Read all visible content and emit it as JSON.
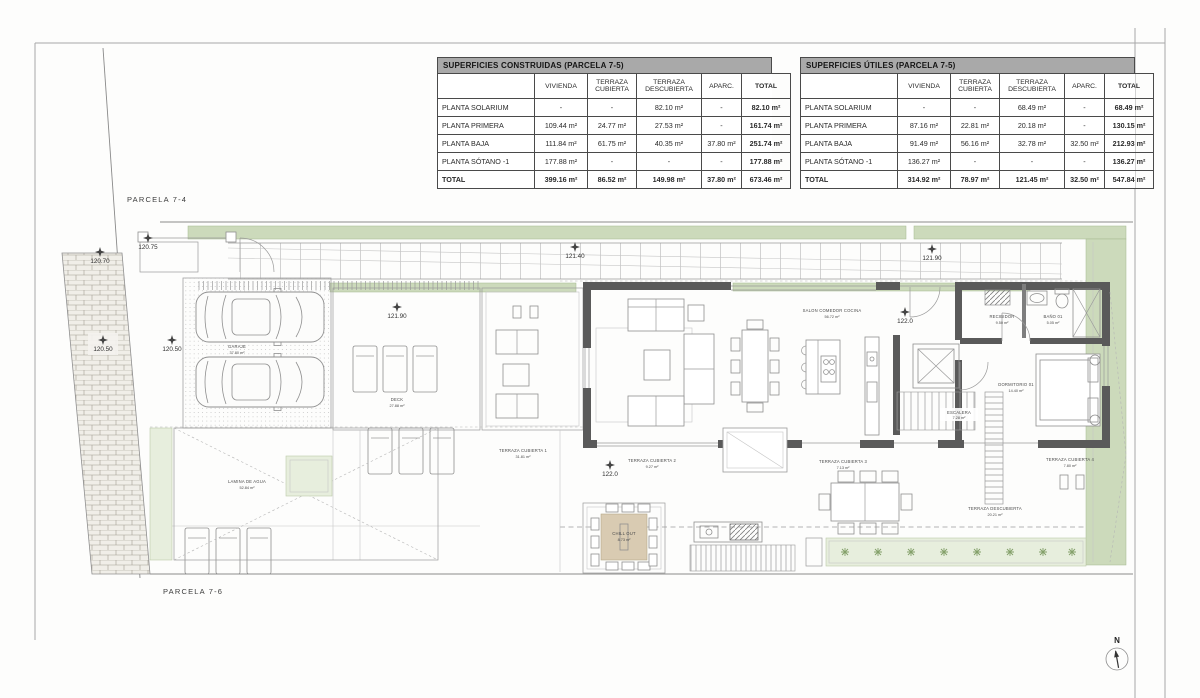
{
  "tables": {
    "construidas": {
      "title": "SUPERFICIES CONSTRUIDAS (PARCELA 7-5)",
      "columns": [
        "",
        "VIVIENDA",
        "TERRAZA CUBIERTA",
        "TERRAZA DESCUBIERTA",
        "APARC.",
        "TOTAL"
      ],
      "rows": [
        [
          "PLANTA SOLARIUM",
          "-",
          "-",
          "82.10 m²",
          "-",
          "82.10 m²"
        ],
        [
          "PLANTA PRIMERA",
          "109.44 m²",
          "24.77 m²",
          "27.53 m²",
          "-",
          "161.74 m²"
        ],
        [
          "PLANTA BAJA",
          "111.84 m²",
          "61.75 m²",
          "40.35 m²",
          "37.80 m²",
          "251.74 m²"
        ],
        [
          "PLANTA SÓTANO -1",
          "177.88 m²",
          "-",
          "-",
          "-",
          "177.88 m²"
        ],
        [
          "TOTAL",
          "399.16 m²",
          "86.52 m²",
          "149.98 m²",
          "37.80 m²",
          "673.46 m²"
        ]
      ]
    },
    "utiles": {
      "title": "SUPERFICIES ÚTILES (PARCELA 7-5)",
      "columns": [
        "",
        "VIVIENDA",
        "TERRAZA CUBIERTA",
        "TERRAZA DESCUBIERTA",
        "APARC.",
        "TOTAL"
      ],
      "rows": [
        [
          "PLANTA SOLARIUM",
          "-",
          "-",
          "68.49 m²",
          "-",
          "68.49 m²"
        ],
        [
          "PLANTA PRIMERA",
          "87.16 m²",
          "22.81 m²",
          "20.18 m²",
          "-",
          "130.15 m²"
        ],
        [
          "PLANTA BAJA",
          "91.49 m²",
          "56.16 m²",
          "32.78 m²",
          "32.50 m²",
          "212.93 m²"
        ],
        [
          "PLANTA SÓTANO -1",
          "136.27 m²",
          "-",
          "-",
          "-",
          "136.27 m²"
        ],
        [
          "TOTAL",
          "314.92 m²",
          "78.97 m²",
          "121.45 m²",
          "32.50 m²",
          "547.84 m²"
        ]
      ]
    }
  },
  "plan": {
    "parcel_top": "PARCELA 7-4",
    "parcel_bottom": "PARCELA 7-6",
    "north": "N",
    "elevations": {
      "e1": "120.75",
      "e2": "120.70",
      "e3": "120.50",
      "e4": "120.50",
      "e5": "121.90",
      "e6": "121.40",
      "e7": "121.90",
      "e8": "122.0",
      "e9": "122.0"
    },
    "rooms": {
      "salon": {
        "name": "SALON COMEDOR COCINA",
        "area": "56.72 m²"
      },
      "garaje": {
        "name": "GARAJE",
        "area": "37.80 m²"
      },
      "deck": {
        "name": "DECK",
        "area": "27.88 m²"
      },
      "terraza1": {
        "name": "TERRAZA CUBIERTA 1",
        "area": "31.81 m²"
      },
      "terraza2": {
        "name": "TERRAZA CUBIERTA 2",
        "area": "9.27 m²"
      },
      "terraza3": {
        "name": "TERRAZA CUBIERTA 3",
        "area": "7.13 m²"
      },
      "terraza4": {
        "name": "TERRAZA CUBIERTA 4",
        "area": "7.80 m²"
      },
      "terrazaD": {
        "name": "TERRAZA DESCUBIERTA",
        "area": "20.21 m²"
      },
      "lamina": {
        "name": "LAMINA DE AGUA",
        "area": "52.84 m²"
      },
      "chillout": {
        "name": "CHILL OUT",
        "area": "8.73 m²"
      },
      "escalera": {
        "name": "ESCALERA",
        "area": "7.28 m²"
      },
      "recibidor": {
        "name": "RECIBIDOR",
        "area": "9.50 m²"
      },
      "bano": {
        "name": "BAÑO 01",
        "area": "5.05 m²"
      },
      "dormitorio": {
        "name": "DORMITORIO 01",
        "area": "14.40 m²"
      }
    },
    "colors": {
      "wall": "#5a5a5a",
      "hedge": "#ccdabb",
      "planted_bed": "#e7eedd",
      "chillout_table": "#d9cbb2"
    }
  }
}
